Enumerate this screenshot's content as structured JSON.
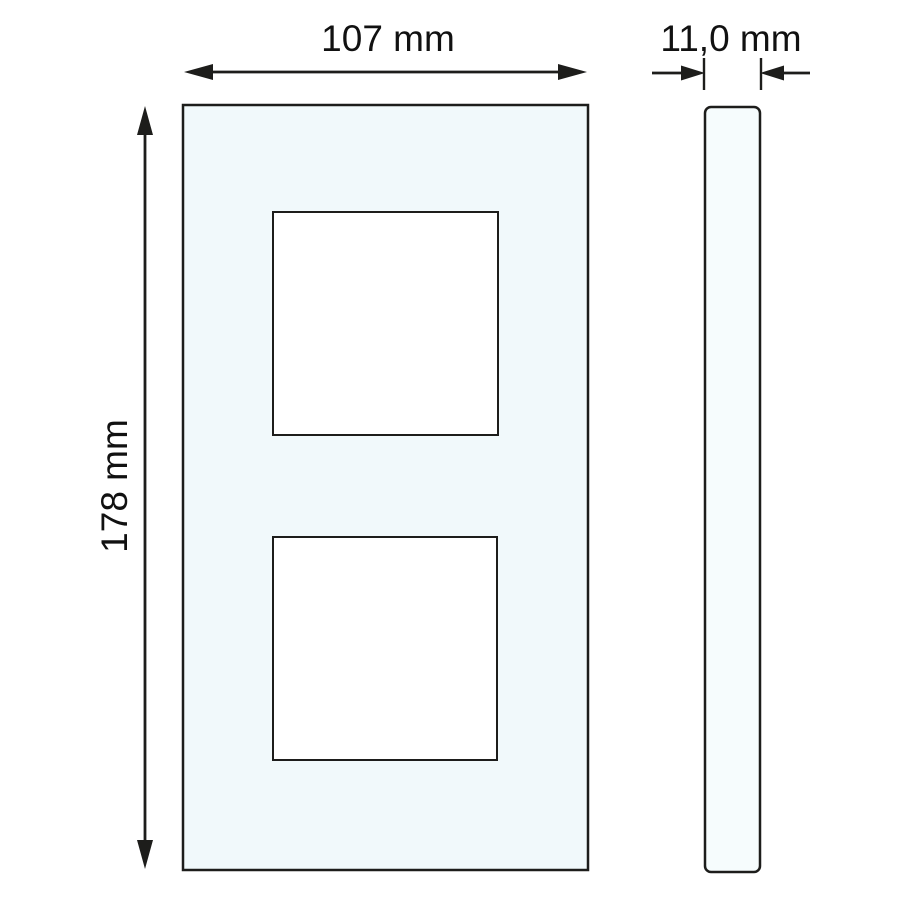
{
  "figure": {
    "type": "technical-dimension-drawing",
    "description": "Dimensional drawing of a 2-gang switch cover frame: front view with two square cutouts and a side (profile) view",
    "background_color": "#ffffff",
    "line_color": "#1d1d1b",
    "text_color": "#111111",
    "front_view": {
      "fill": "#f1f9fb",
      "cutout_fill": "#ffffff",
      "cutout_count": 2
    },
    "side_view": {
      "fill": "#f6fcfd"
    },
    "dimensions": {
      "width": {
        "label": "107 mm",
        "value_mm": 107
      },
      "height": {
        "label": "178 mm",
        "value_mm": 178
      },
      "depth": {
        "label": "11,0 mm",
        "value_mm": 11.0
      }
    }
  }
}
